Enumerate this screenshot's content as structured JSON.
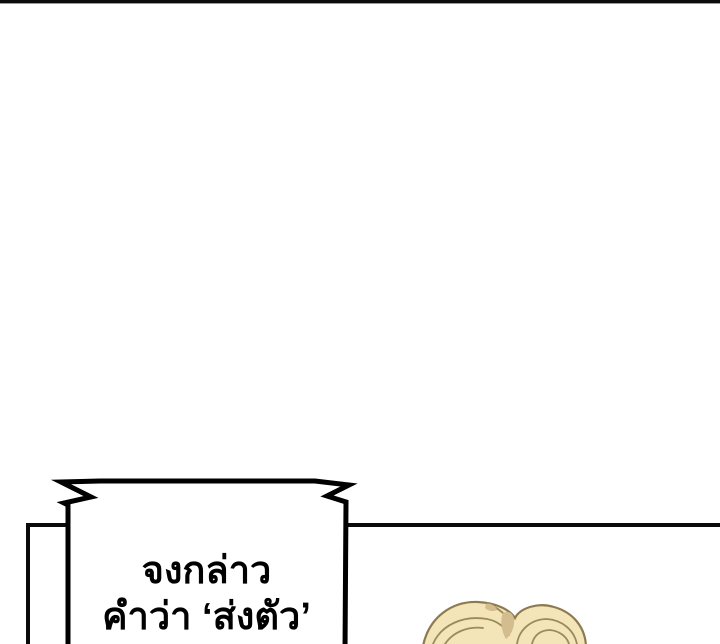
{
  "page": {
    "background_color": "#ffffff",
    "divider_bar_color": "#0b0b0b"
  },
  "panel": {
    "border_color": "#0a0a0a"
  },
  "speech_bubble": {
    "style": "shout-bubble-jagged",
    "fill_color": "#ffffff",
    "border_color": "#000000",
    "lines": {
      "0": "จงกล่าว",
      "1": "คำว่า ‘ส่งตัว’"
    }
  },
  "character": {
    "part": "blonde-hair-top",
    "hair_fill_color": "#f3e5b8",
    "hair_outline_color": "#8d7a50",
    "hair_strand_color": "#9c8a5d",
    "hair_shadow_color": "#d3bc8d"
  }
}
